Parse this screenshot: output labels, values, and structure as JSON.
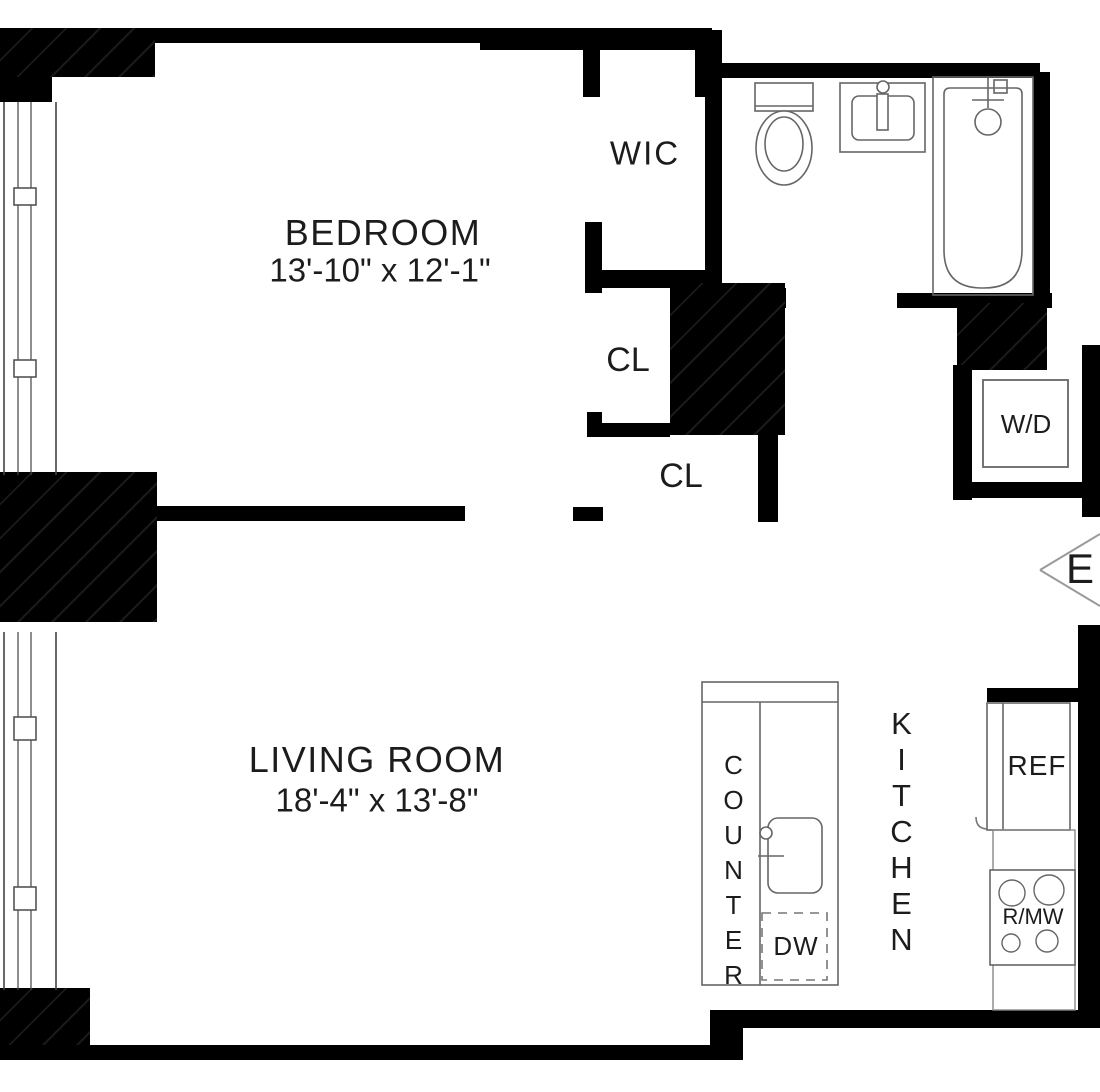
{
  "plan": {
    "bedroom": {
      "label": "BEDROOM",
      "dims": "13'-10\" x 12'-1\""
    },
    "living_room": {
      "label": "LIVING ROOM",
      "dims": "18'-4\" x 13'-8\""
    },
    "wic_label": "WIC",
    "closet_upper_label": "CL",
    "closet_lower_label": "CL",
    "counter_label": "COUNTER",
    "dishwasher_label": "DW",
    "kitchen_label": "KITCHEN",
    "refrigerator_label": "REF",
    "range_microwave_label": "R/MW",
    "washer_dryer_label": "W/D",
    "compass_east_label": "E"
  },
  "colors": {
    "wall": "#000000",
    "fixture_line": "#666666",
    "window_line": "#444444",
    "text": "#1c1c1c",
    "background": "#ffffff"
  }
}
